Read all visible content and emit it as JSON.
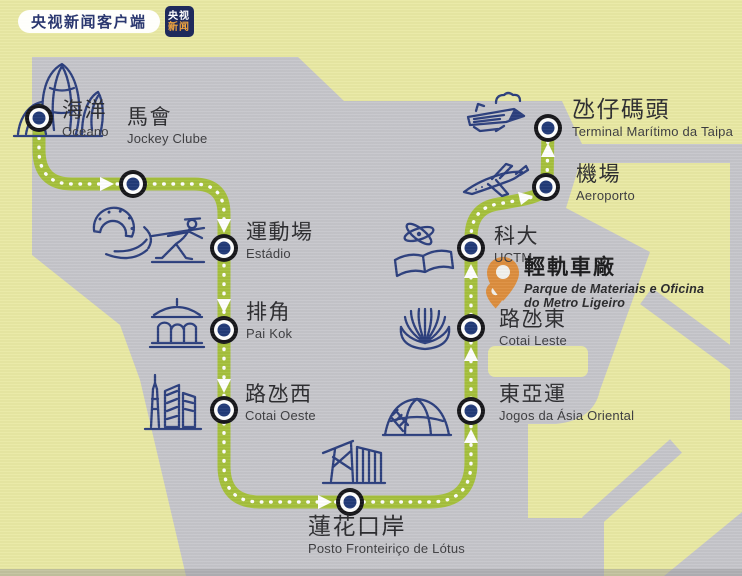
{
  "watermark": {
    "app_name": "央视新闻客户端",
    "badge_top": "央视",
    "badge_bottom": "新闻"
  },
  "map": {
    "title_implicit": "Macau LRT Taipa line route map",
    "stations": [
      {
        "id": "oceano",
        "zh": "海洋",
        "pt": "Oceano"
      },
      {
        "id": "jockey-clube",
        "zh": "馬會",
        "pt": "Jockey Clube"
      },
      {
        "id": "estadio",
        "zh": "運動場",
        "pt": "Estádio"
      },
      {
        "id": "pai-kok",
        "zh": "排角",
        "pt": "Pai Kok"
      },
      {
        "id": "cotai-oeste",
        "zh": "路氹西",
        "pt": "Cotai Oeste"
      },
      {
        "id": "lotus",
        "zh": "蓮花口岸",
        "pt": "Posto Fronteiriço de Lótus"
      },
      {
        "id": "jogos",
        "zh": "東亞運",
        "pt": "Jogos da Ásia Oriental"
      },
      {
        "id": "cotai-leste",
        "zh": "路氹東",
        "pt": "Cotai Leste"
      },
      {
        "id": "uctm",
        "zh": "科大",
        "pt": "UCTM"
      },
      {
        "id": "aeroporto",
        "zh": "機場",
        "pt": "Aeroporto"
      },
      {
        "id": "terminal",
        "zh": "氹仔碼頭",
        "pt": "Terminal Marítimo da Taipa"
      }
    ],
    "depot": {
      "zh": "輕軌車廠",
      "pt1": "Parque de Materiais e Oficina",
      "pt2": "do Metro Ligeiro"
    }
  },
  "colors": {
    "background": "#e9e9a4",
    "land": "#c6c6cb",
    "route_green": "#a6c13c",
    "station_core_navy": "#223a78",
    "station_ring_black": "#17171b",
    "icon_navy": "#2c3f7e",
    "depot_orange": "#dd8e3e",
    "text_dark": "#2d2d30",
    "watermark_navy": "#1e2a5c",
    "watermark_orange": "#efa43e"
  }
}
